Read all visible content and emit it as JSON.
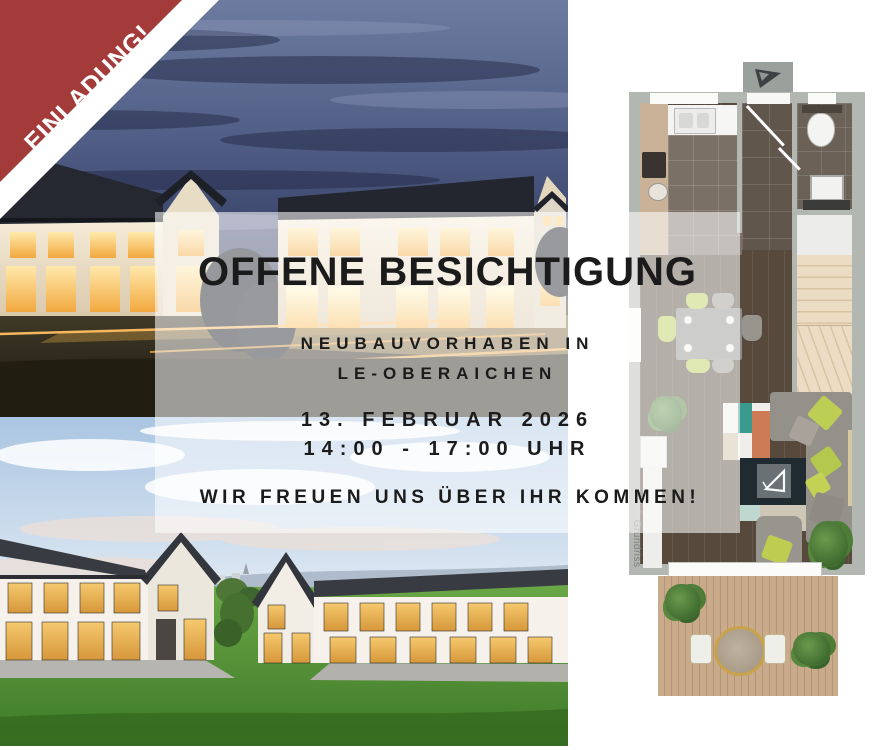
{
  "ribbon": {
    "label": "EINLADUNG!",
    "color": "#A43B3B"
  },
  "overlay": {
    "title": "OFFENE BESICHTIGUNG",
    "location_line1": "NEUBAUVORHABEN IN",
    "location_line2": "LE-OBERAICHEN",
    "date": "13. FEBRUAR 2026",
    "time": "14:00 - 17:00 UHR",
    "closing": "WIR FREUEN UNS ÜBER IHR KOMMEN!"
  },
  "floorplan": {
    "watermark_prefix": "Mein",
    "watermark_suffix": "Grundriss",
    "accent_colors": {
      "stairs_beige": "#EADAC0",
      "pillow_lime": "#B9CA55",
      "tv_board_teal": "#3A9A8E",
      "tv_board_orange": "#CD7A56",
      "wall_gray": "#B3B7B2"
    }
  },
  "colors": {
    "text_dark": "#1B1B1B",
    "overlay_white": "rgba(255,255,255,0.56)"
  }
}
